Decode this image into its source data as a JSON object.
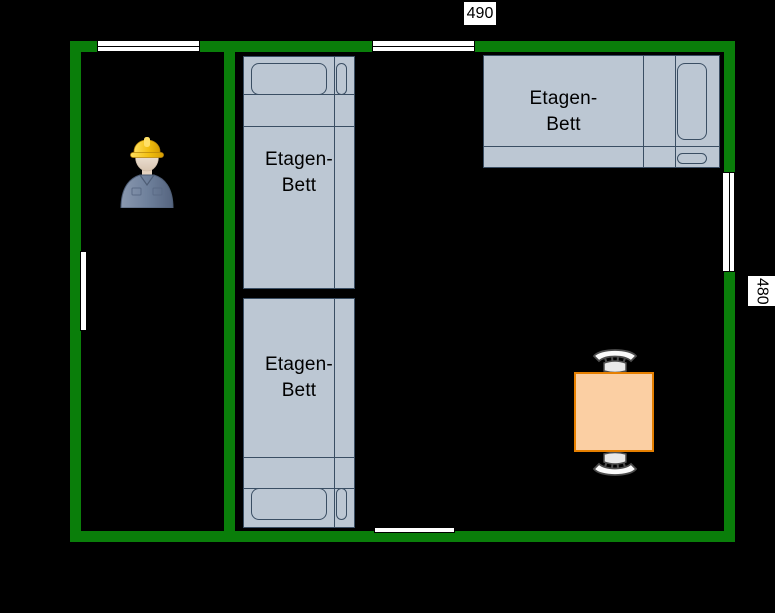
{
  "canvas": {
    "background": "#000000"
  },
  "dimensions": {
    "width_label": "490",
    "height_label": "480"
  },
  "beds": [
    {
      "name": "bunk-bed-middle-top",
      "label_line1": "Etagen-",
      "label_line2": "Bett"
    },
    {
      "name": "bunk-bed-middle-bottom",
      "label_line1": "Etagen-",
      "label_line2": "Bett"
    },
    {
      "name": "bunk-bed-top-right",
      "label_line1": "Etagen-",
      "label_line2": "Bett"
    }
  ],
  "furniture": {
    "table": "square-table",
    "chairs": [
      "chair-top",
      "chair-bottom"
    ],
    "person": "construction-worker"
  },
  "colors": {
    "canvas_bg": "#000000",
    "wall_green": "#0a7e0a",
    "bed_fill": "#bcc7d3",
    "bed_stroke": "#3a4e63",
    "table_fill": "#fbcfa3",
    "table_stroke": "#e57f00",
    "window_fill": "#ffffff",
    "window_border": "#000000",
    "label_bg": "#ffffff",
    "label_text": "#000000",
    "hat_yellow": "#f2c011",
    "shirt_blue": "#6f819c"
  }
}
